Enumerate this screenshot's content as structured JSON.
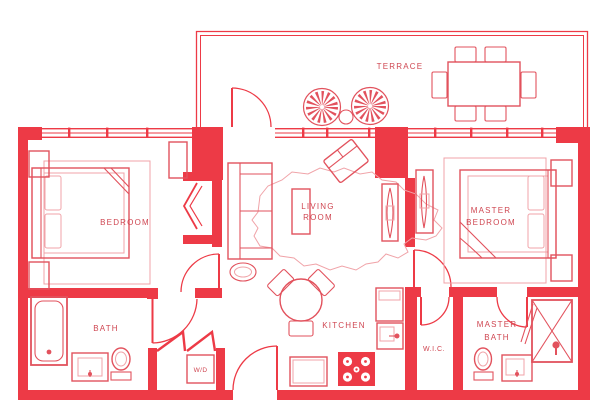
{
  "colors": {
    "wall": "#ed3a46",
    "furniture_line": "#e2525d",
    "light_line": "#f0a3a8",
    "label_text": "#cf4651",
    "background": "#ffffff"
  },
  "floorplan": {
    "labels": {
      "terrace": "TERRACE",
      "living_room": [
        "LIVING",
        "ROOM"
      ],
      "bedroom": "BEDROOM",
      "master_bedroom": [
        "MASTER",
        "BEDROOM"
      ],
      "bath": "BATH",
      "kitchen": "KITCHEN",
      "washer_dryer": "W/D",
      "walk_in_closet": "W.I.C.",
      "master_bath": [
        "MASTER",
        "BATH"
      ]
    },
    "furniture": {
      "terrace": [
        "rect-dining-table",
        "dining-chair",
        "dining-chair",
        "dining-chair",
        "dining-chair",
        "dining-chair",
        "dining-chair",
        "round-lounge-chair",
        "round-lounge-chair",
        "small-round-table"
      ],
      "living_room": [
        "sofa",
        "coffee-table",
        "area-rug",
        "angled-armchair",
        "tv-console",
        "oval-side-table"
      ],
      "bedroom": [
        "double-bed",
        "nightstand",
        "nightstand",
        "rug",
        "bifold-closet",
        "cabinet"
      ],
      "master_bedroom": [
        "double-bed",
        "nightstand",
        "nightstand",
        "rug",
        "tv-console"
      ],
      "kitchen": [
        "round-table",
        "kitchen-chair",
        "kitchen-chair",
        "kitchen-chair",
        "counter",
        "stove",
        "refrigerator",
        "sink-cabinet"
      ],
      "bath": [
        "bathtub",
        "vanity-sink",
        "toilet"
      ],
      "master_bath": [
        "shower",
        "vanity-sink",
        "toilet"
      ],
      "utility": [
        "washer-dryer"
      ]
    }
  }
}
